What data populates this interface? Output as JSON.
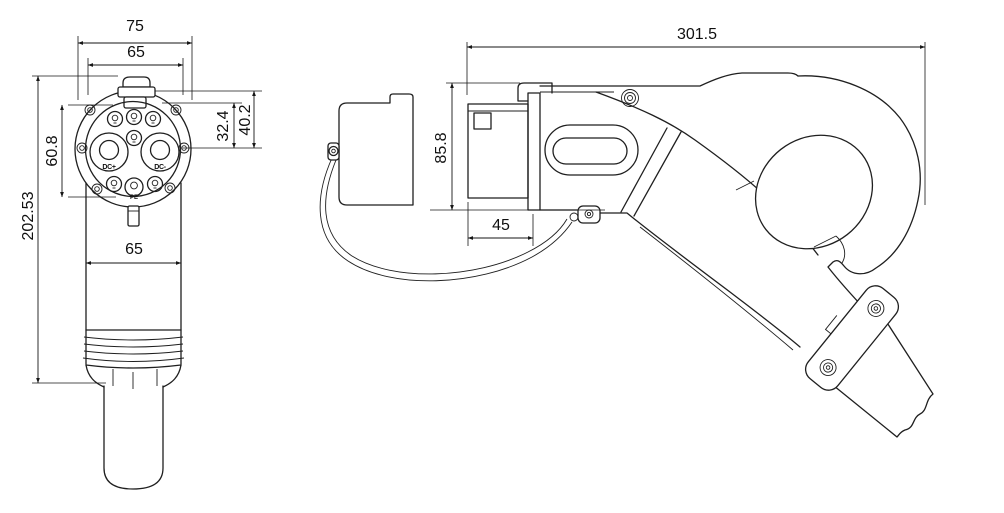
{
  "drawing": {
    "type": "technical-drawing",
    "subject": "EV DC charging connector (front face view and side view)",
    "style": {
      "line_color": "#1f1f1f",
      "dim_text_color": "#101010",
      "background": "#ffffff"
    },
    "front": {
      "dims": {
        "overall_width": "75",
        "face_width": "65",
        "pin_span": "60.8",
        "overall_height": "202.53",
        "pin_offset_inner": "32.4",
        "pin_offset_outer": "40.2",
        "body_width": "65"
      },
      "pins": {
        "dc_plus": "DC+",
        "dc_minus": "DC-",
        "pe": "PE"
      }
    },
    "side": {
      "dims": {
        "overall_length": "301.5",
        "face_height": "85.8",
        "nozzle_depth": "45"
      }
    }
  }
}
